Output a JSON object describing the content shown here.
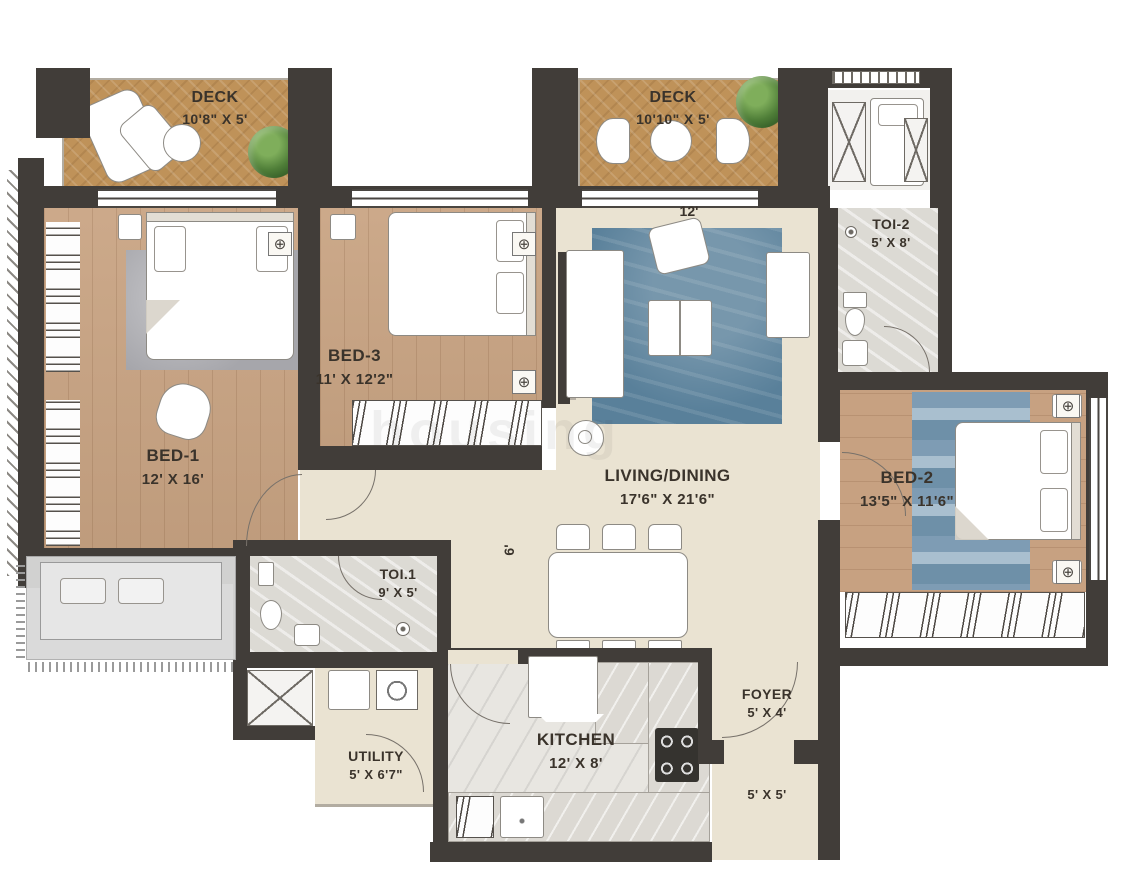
{
  "watermark": "housing",
  "rooms": {
    "deck_left": {
      "name": "DECK",
      "dims": "10'8\" X 5'"
    },
    "deck_right": {
      "name": "DECK",
      "dims": "10'10\" X 5'"
    },
    "bed1": {
      "name": "BED-1",
      "dims": "12' X 16'"
    },
    "bed3": {
      "name": "BED-3",
      "dims": "11' X 12'2\""
    },
    "living": {
      "name": "LIVING/DINING",
      "dims": "17'6\" X 21'6\""
    },
    "bed2": {
      "name": "BED-2",
      "dims": "13'5\" X 11'6\""
    },
    "toi2": {
      "name": "TOI-2",
      "dims": "5' X 8'"
    },
    "toi1": {
      "name": "TOI.1",
      "dims": "9' X 5'"
    },
    "utility": {
      "name": "UTILITY",
      "dims": "5' X 6'7\""
    },
    "kitchen": {
      "name": "KITCHEN",
      "dims": "12' X 8'"
    },
    "foyer": {
      "name": "FOYER",
      "dims": "5' X 4'"
    },
    "passage": {
      "dims": "5' X 5'"
    }
  },
  "dimension_notes": {
    "living_top_width": "12'",
    "corridor_width": "6'"
  },
  "colors": {
    "wall": "#413d39",
    "wood_floor": "#c9a483",
    "deck_floor": "#bf9259",
    "cream_floor": "#eae3d2",
    "marble_floor": "#dcdad4",
    "living_rug": "#59809a",
    "label_text": "#3a332b"
  }
}
